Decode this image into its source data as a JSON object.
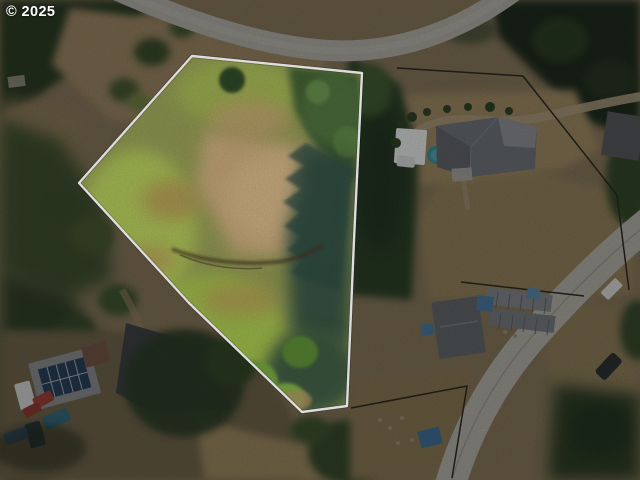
{
  "watermark": {
    "text": "© 2025"
  },
  "lot": {
    "polygon_points": "192,56 362,73 354,240 347,406 302,412 189,303 79,183",
    "boundary_color": "#ffffff"
  },
  "colors": {
    "boundary_line": "#ffffff",
    "watermark_text": "#ffffff",
    "lot_brush_lime": "#a8bd55",
    "lot_dirt_clearing": "#c2a477",
    "conifer_dark": "#2c3e26",
    "tree_shadow_teal": "#2e4c42",
    "road_asphalt": "#b2b0a8",
    "pool_teal": "#3a93a2",
    "main_roof_grey": "#70747a",
    "big_roof_charcoal": "#3d4045",
    "solar_panel_blue": "#27405a",
    "tarp_blue": "#4a7ba1"
  }
}
